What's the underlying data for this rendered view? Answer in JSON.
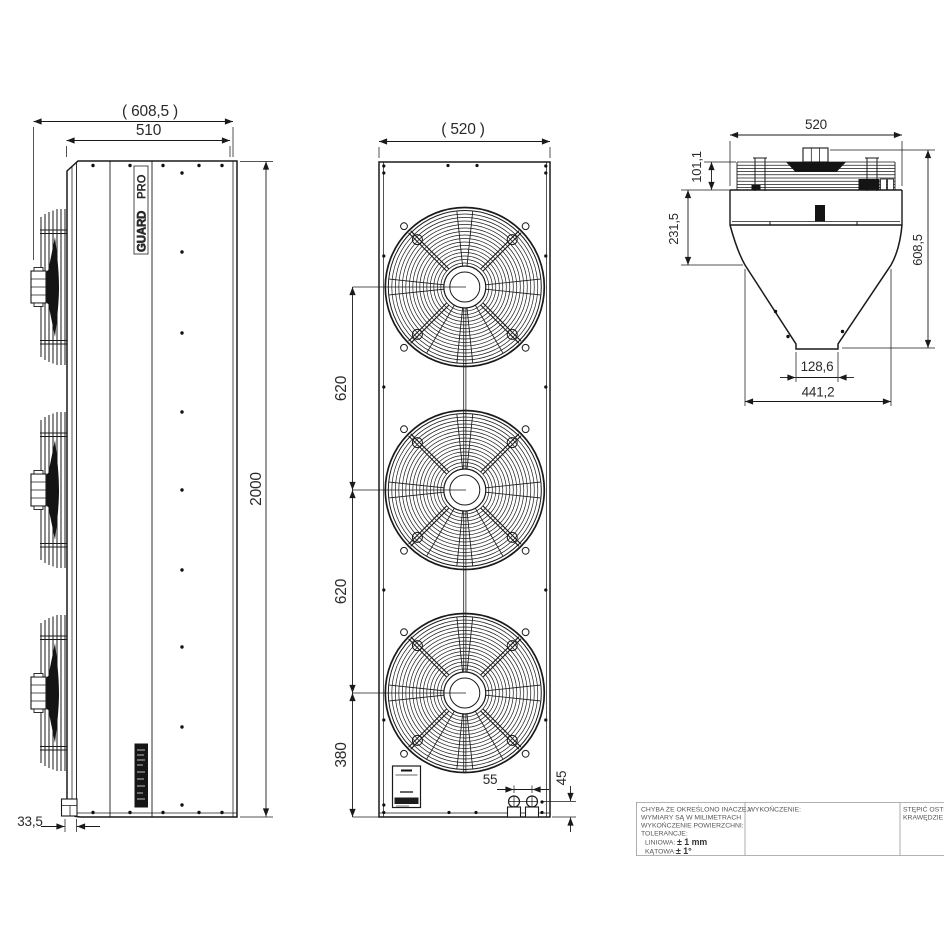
{
  "drawing_type": "technical-drawing",
  "views": {
    "side": {
      "dims": {
        "overall_depth": "( 608,5 )",
        "body_depth": "510",
        "height": "2000",
        "grille_offset": "33,5"
      },
      "logo_top": "PRO",
      "logo_bottom": "GUARD"
    },
    "front": {
      "dims": {
        "width": "( 520 )",
        "fan_pitch_upper": "620",
        "fan_pitch_lower": "620",
        "bottom_fan_offset": "380",
        "gland_spacing": "55",
        "gland_offset": "45"
      }
    },
    "top": {
      "dims": {
        "width": "520",
        "grille_height": "101,1",
        "plenum_height": "231,5",
        "overall_height": "608,5",
        "outlet_width": "128,6",
        "funnel_width": "441,2"
      }
    }
  },
  "title_block": {
    "notes": [
      "CHYBA ŻE OKREŚLONO INACZEJ:",
      "WYMIARY SĄ W MILIMETRACH",
      "WYKOŃCZENIE POWIERZCHNI:",
      "TOLERANCJE:"
    ],
    "tolerance_linear_label": "LINIOWA:",
    "tolerance_linear_value": "± 1 mm",
    "tolerance_angular_label": "KĄTOWA:",
    "tolerance_angular_value": "± 1°",
    "finish_label": "WYKOŃCZENIE:",
    "edge_note_line1": "STĘPIĆ OSTRE",
    "edge_note_line2": "KRAWĘDZIE"
  },
  "colors": {
    "line": "#1a1a1a",
    "background": "#ffffff",
    "title_text": "#575757"
  }
}
